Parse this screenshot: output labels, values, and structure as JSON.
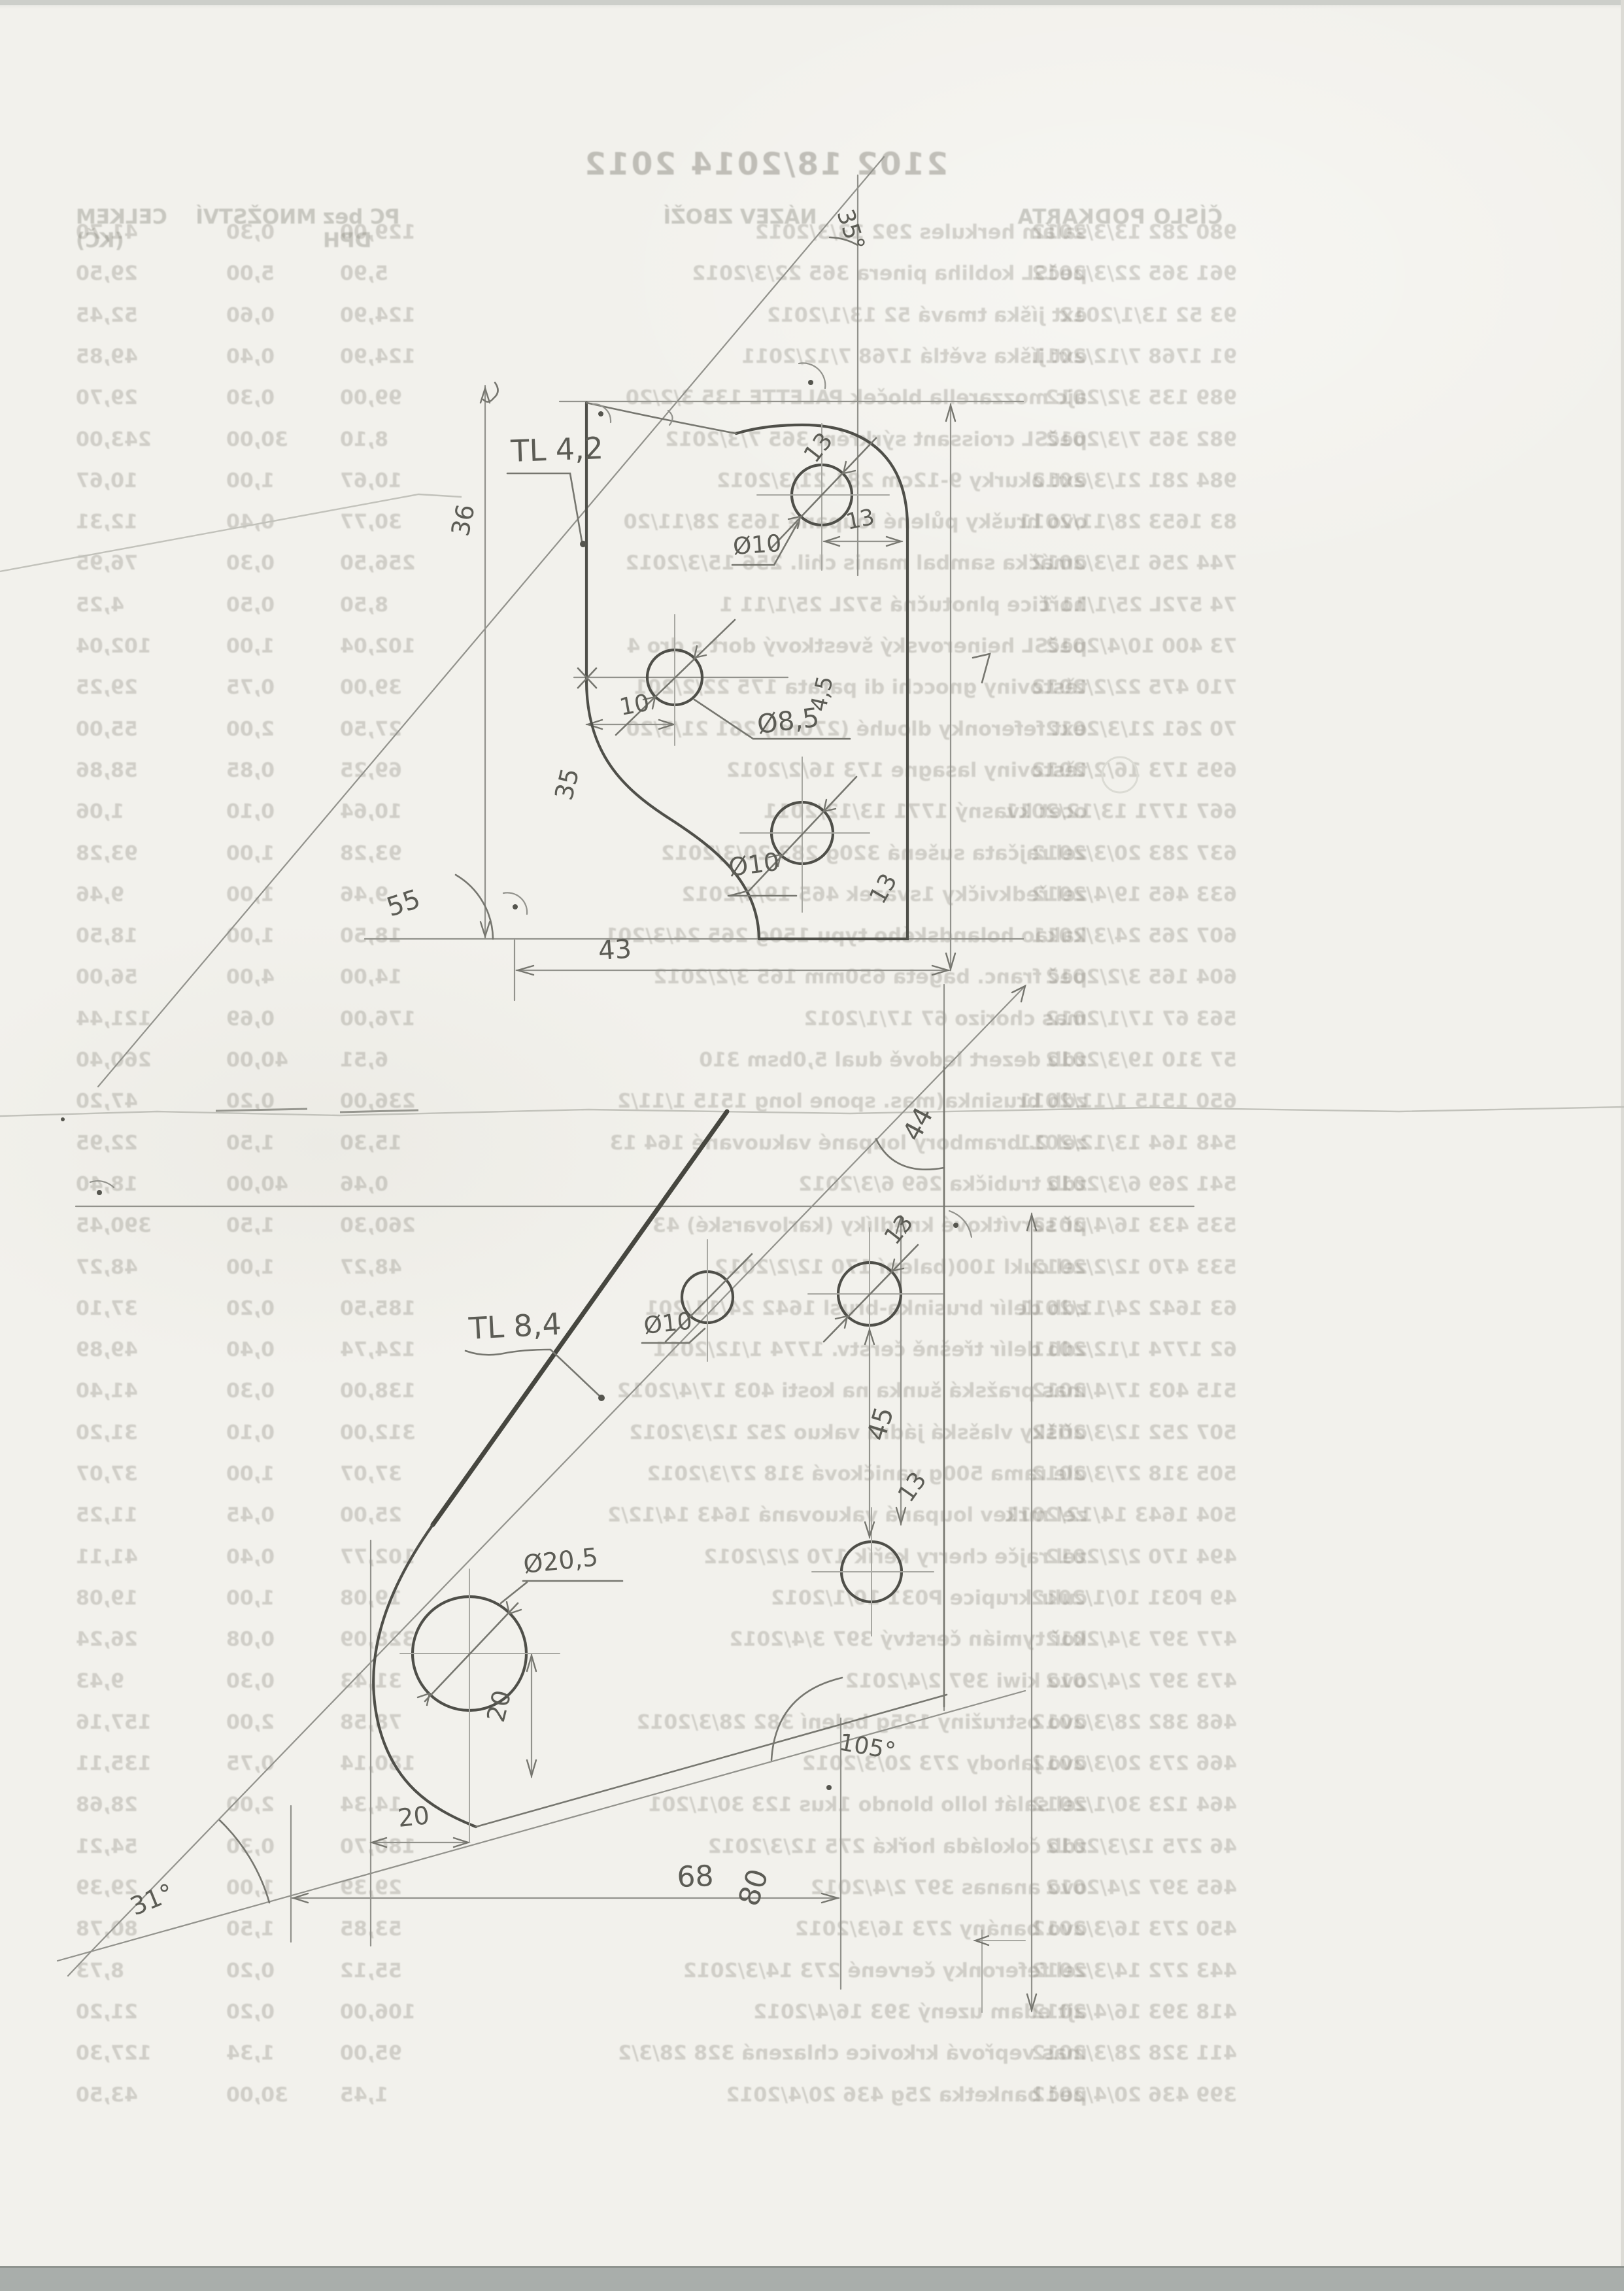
{
  "receipt": {
    "title": "2102 18/2014 2012",
    "headers": {
      "cislo": "ČÍSLO   PODKARTA",
      "nazev": "NÁZEV ZBOŽÍ",
      "pc": "PC bez DPH",
      "mnozstvi": "MNOŽSTVÍ",
      "celkem": "CELKEM (KČ)"
    },
    "rows": [
      {
        "code": "980 282 13/3/2012",
        "name": "salám herkules 292 13/3/2012",
        "price": "129,00",
        "qty": "0,30",
        "total": "41,70"
      },
      {
        "code": "961 365 22/3/2012",
        "name": "pečSL kobliha pinera 365 22/3/2012",
        "price": "5,90",
        "qty": "5,00",
        "total": "29,50"
      },
      {
        "code": "93 52 13/1/2012",
        "name": "ext jíška tmavá 52 13/1/2012",
        "price": "124,90",
        "qty": "0,60",
        "total": "52,45"
      },
      {
        "code": "91 1768 7/12/2011",
        "name": "ext jíška světlá 1768 7/12/2011",
        "price": "124,90",
        "qty": "0,40",
        "total": "49,85"
      },
      {
        "code": "989 135 3/2/2012",
        "name": "ajc mozzarella bloček PALETTE 135 3/2/20",
        "price": "99,00",
        "qty": "0,30",
        "total": "29,70"
      },
      {
        "code": "982 365 7/3/2012",
        "name": "pečSL croissant sýrkrém 365 7/3/2012",
        "price": "8,10",
        "qty": "30,00",
        "total": "243,00"
      },
      {
        "code": "984 281 21/3/2012",
        "name": "ext okurky 9-12cm 281 21/3/2012",
        "price": "10,67",
        "qty": "1,00",
        "total": "10,67"
      },
      {
        "code": "83 1653 28/11/2011",
        "name": "ovo hrušky půlené loupané 1653 28/11/20",
        "price": "30,77",
        "qty": "0,40",
        "total": "12,31"
      },
      {
        "code": "744 256 15/3/2012",
        "name": "omáčka sambal manis chil. 256 15/3/2012",
        "price": "256,50",
        "qty": "0,30",
        "total": "76,95"
      },
      {
        "code": "74 572L 25/1/11 1",
        "name": "hořčice plnotučná 572L 25/1/11 1",
        "price": "8,50",
        "qty": "0,50",
        "total": "4,25"
      },
      {
        "code": "73 400 10/4/2012",
        "name": "pečSL heinerovský švestkový dort s dro 4",
        "price": "102,04",
        "qty": "1,00",
        "total": "102,04"
      },
      {
        "code": "710 475 22/2/2012",
        "name": "těstoviny gnocchi di patata 175 22/2/201",
        "price": "39,00",
        "qty": "0,75",
        "total": "29,25"
      },
      {
        "code": "70 261 21/3/2012",
        "name": "ext feferonky dlouhé (270ml) 261 21/3/20",
        "price": "27,50",
        "qty": "2,00",
        "total": "55,00"
      },
      {
        "code": "695 173 16/2/2012",
        "name": "těstoviny lasagne 173 16/2/2012",
        "price": "69,25",
        "qty": "0,85",
        "total": "58,86"
      },
      {
        "code": "667 1771 13/12/2011",
        "name": "ocet kvasný 1771 13/12/2011",
        "price": "10,64",
        "qty": "0,10",
        "total": "1,06"
      },
      {
        "code": "637 283 20/3/2012",
        "name": "zel rajčata sušená 320g 283 20/3/2012",
        "price": "93,28",
        "qty": "1,00",
        "total": "93,28"
      },
      {
        "code": "633 465 19/4/2012",
        "name": "zel ředkvičky 1svazek 465 19/4/2012",
        "price": "9,46",
        "qty": "1,00",
        "total": "9,46"
      },
      {
        "code": "607 265 24/3/2011",
        "name": "kakao holandského typu 150g 265 24/3/201",
        "price": "18,50",
        "qty": "1,00",
        "total": "18,50"
      },
      {
        "code": "604 165 3/2/2012",
        "name": "peč franc. bageta 650mm 165 3/2/2012",
        "price": "14,00",
        "qty": "4,00",
        "total": "56,00"
      },
      {
        "code": "563 67 17/1/2012",
        "name": "mas chorizo 67 17/1/2012",
        "price": "176,00",
        "qty": "0,69",
        "total": "121,44"
      },
      {
        "code": "57 310 19/3/2012",
        "name": "zdb dezert ledově dual 5,0bsm 310",
        "price": "6,51",
        "qty": "40,00",
        "total": "260,40"
      },
      {
        "code": "650 1515 1/11/2011",
        "name": "zdb brusinka(mas. spone long 1515 1/11/2",
        "price": "236,00",
        "qty": "0,20",
        "total": "47,20"
      },
      {
        "code": "548 164 13/12/2011",
        "name": "zel 2. brambory loupané vakuované 164 13",
        "price": "15,30",
        "qty": "1,50",
        "total": "22,95"
      },
      {
        "code": "541 269 6/3/2012",
        "name": "zdb trubička 269 6/3/2012",
        "price": "0,46",
        "qty": "40,00",
        "total": "18,40"
      },
      {
        "code": "535 433 16/4/2012",
        "name": "př servítkové knedlíky (karlovarské) 43",
        "price": "260,30",
        "qty": "1,50",
        "total": "390,45"
      },
      {
        "code": "533 470 12/2/2012",
        "name": "zel cukl 100(balení 170 12/2/2012",
        "price": "48,27",
        "qty": "1,00",
        "total": "48,27"
      },
      {
        "code": "63 1642 24/11/2011",
        "name": "zdb delír brusinka-brusl 1642 24/11/201",
        "price": "185,50",
        "qty": "0,20",
        "total": "37,10"
      },
      {
        "code": "62 1774 1/12/2011",
        "name": "zdb delír třešně čerstv. 1774 1/12/2011",
        "price": "124,74",
        "qty": "0,40",
        "total": "49,89"
      },
      {
        "code": "515 403 17/4/2012",
        "name": "mas pražská šunka na kosti 403 17/4/2012",
        "price": "138,00",
        "qty": "0,30",
        "total": "41,40"
      },
      {
        "code": "507 252 12/3/2012",
        "name": "ořišky vlašská jádra vakuo 252 12/3/2012",
        "price": "312,00",
        "qty": "0,10",
        "total": "31,20"
      },
      {
        "code": "505 318 27/3/2012",
        "name": "ole rama 500g vaničková 318 27/3/2012",
        "price": "37,07",
        "qty": "1,00",
        "total": "37,07"
      },
      {
        "code": "504 1643 14/12/2011",
        "name": "zel mrkev loupaná vakuovaná 1643 14/12/2",
        "price": "25,00",
        "qty": "0,45",
        "total": "11,25"
      },
      {
        "code": "494 170 2/2/2012",
        "name": "zel rajče cherry keřík 170 2/2/2012",
        "price": "102,77",
        "qty": "0,40",
        "total": "41,11"
      },
      {
        "code": "49 P031 10/1/2012",
        "name": "cukr krupice P031 10/1/2012",
        "price": "19,08",
        "qty": "1,00",
        "total": "19,08"
      },
      {
        "code": "477 397 3/4/2012",
        "name": "koř tymián čerstvý 397 3/4/2012",
        "price": "328,09",
        "qty": "0,08",
        "total": "26,24"
      },
      {
        "code": "473 397 2/4/2012",
        "name": "ovo kiwi 397 2/4/2012",
        "price": "31,43",
        "qty": "0,30",
        "total": "9,43"
      },
      {
        "code": "468 382 28/3/2012",
        "name": "ovo ostružiny 125g balení 382 28/3/2012",
        "price": "78,58",
        "qty": "2,00",
        "total": "157,16"
      },
      {
        "code": "466 273 20/3/2012",
        "name": "ovo jahody 273 20/3/2012",
        "price": "180,14",
        "qty": "0,75",
        "total": "135,11"
      },
      {
        "code": "464 123 30/1/2012",
        "name": "zel salát lollo blondo 1kus 123 30/1/201",
        "price": "14,34",
        "qty": "2,00",
        "total": "28,68"
      },
      {
        "code": "46 275 12/3/2012",
        "name": "zdb čokoláda hořká 275 12/3/2012",
        "price": "180,70",
        "qty": "0,30",
        "total": "54,21"
      },
      {
        "code": "465 397 2/4/2012",
        "name": "ovo ananas 397 2/4/2012",
        "price": "29,39",
        "qty": "1,00",
        "total": "29,39"
      },
      {
        "code": "450 273 16/3/2012",
        "name": "ovo banány 273 16/3/2012",
        "price": "53,85",
        "qty": "1,50",
        "total": "80,78"
      },
      {
        "code": "443 272 14/3/2012",
        "name": "zel feferonky červené 273 14/3/2012",
        "price": "55,12",
        "qty": "0,20",
        "total": "8,73"
      },
      {
        "code": "418 393 16/4/2012",
        "name": "ajt edam uzený 393 16/4/2012",
        "price": "106,00",
        "qty": "0,20",
        "total": "21,20"
      },
      {
        "code": "411 328 28/3/2012",
        "name": "mas vepřová krkovice chlazená 328 28/3/2",
        "price": "95,00",
        "qty": "1,34",
        "total": "127,30"
      },
      {
        "code": "399 436 20/4/2012",
        "name": "peč banketka 25g 436 20/4/2012",
        "price": "1,45",
        "qty": "30,00",
        "total": "43,50"
      }
    ]
  },
  "sketch_top": {
    "label": "TL 4,2",
    "angle_left": "55",
    "angle_top": "35°",
    "dim_height_a": "36",
    "dim_height_b": "35",
    "dim_width": "43",
    "dim_offset": "10",
    "hole_small": "Ø8,5",
    "hole_top": "Ø10",
    "hole_top_dia": "13",
    "dim_edge": "13",
    "hole_lower": "Ø10",
    "hole_lower_dia": "13",
    "thickness": "4,5"
  },
  "sketch_bottom": {
    "label": "TL 8,4",
    "angle_top": "44",
    "angle_left": "31°",
    "angle_right": "105°",
    "dim_top": "45",
    "hole_a": "Ø10",
    "hole_b_dia": "13",
    "holes_gap": "13",
    "hole_big": "Ø20,5",
    "dim_big_v": "20",
    "dim_big_h": "20",
    "dim_width": "68",
    "dim_height": "80"
  }
}
